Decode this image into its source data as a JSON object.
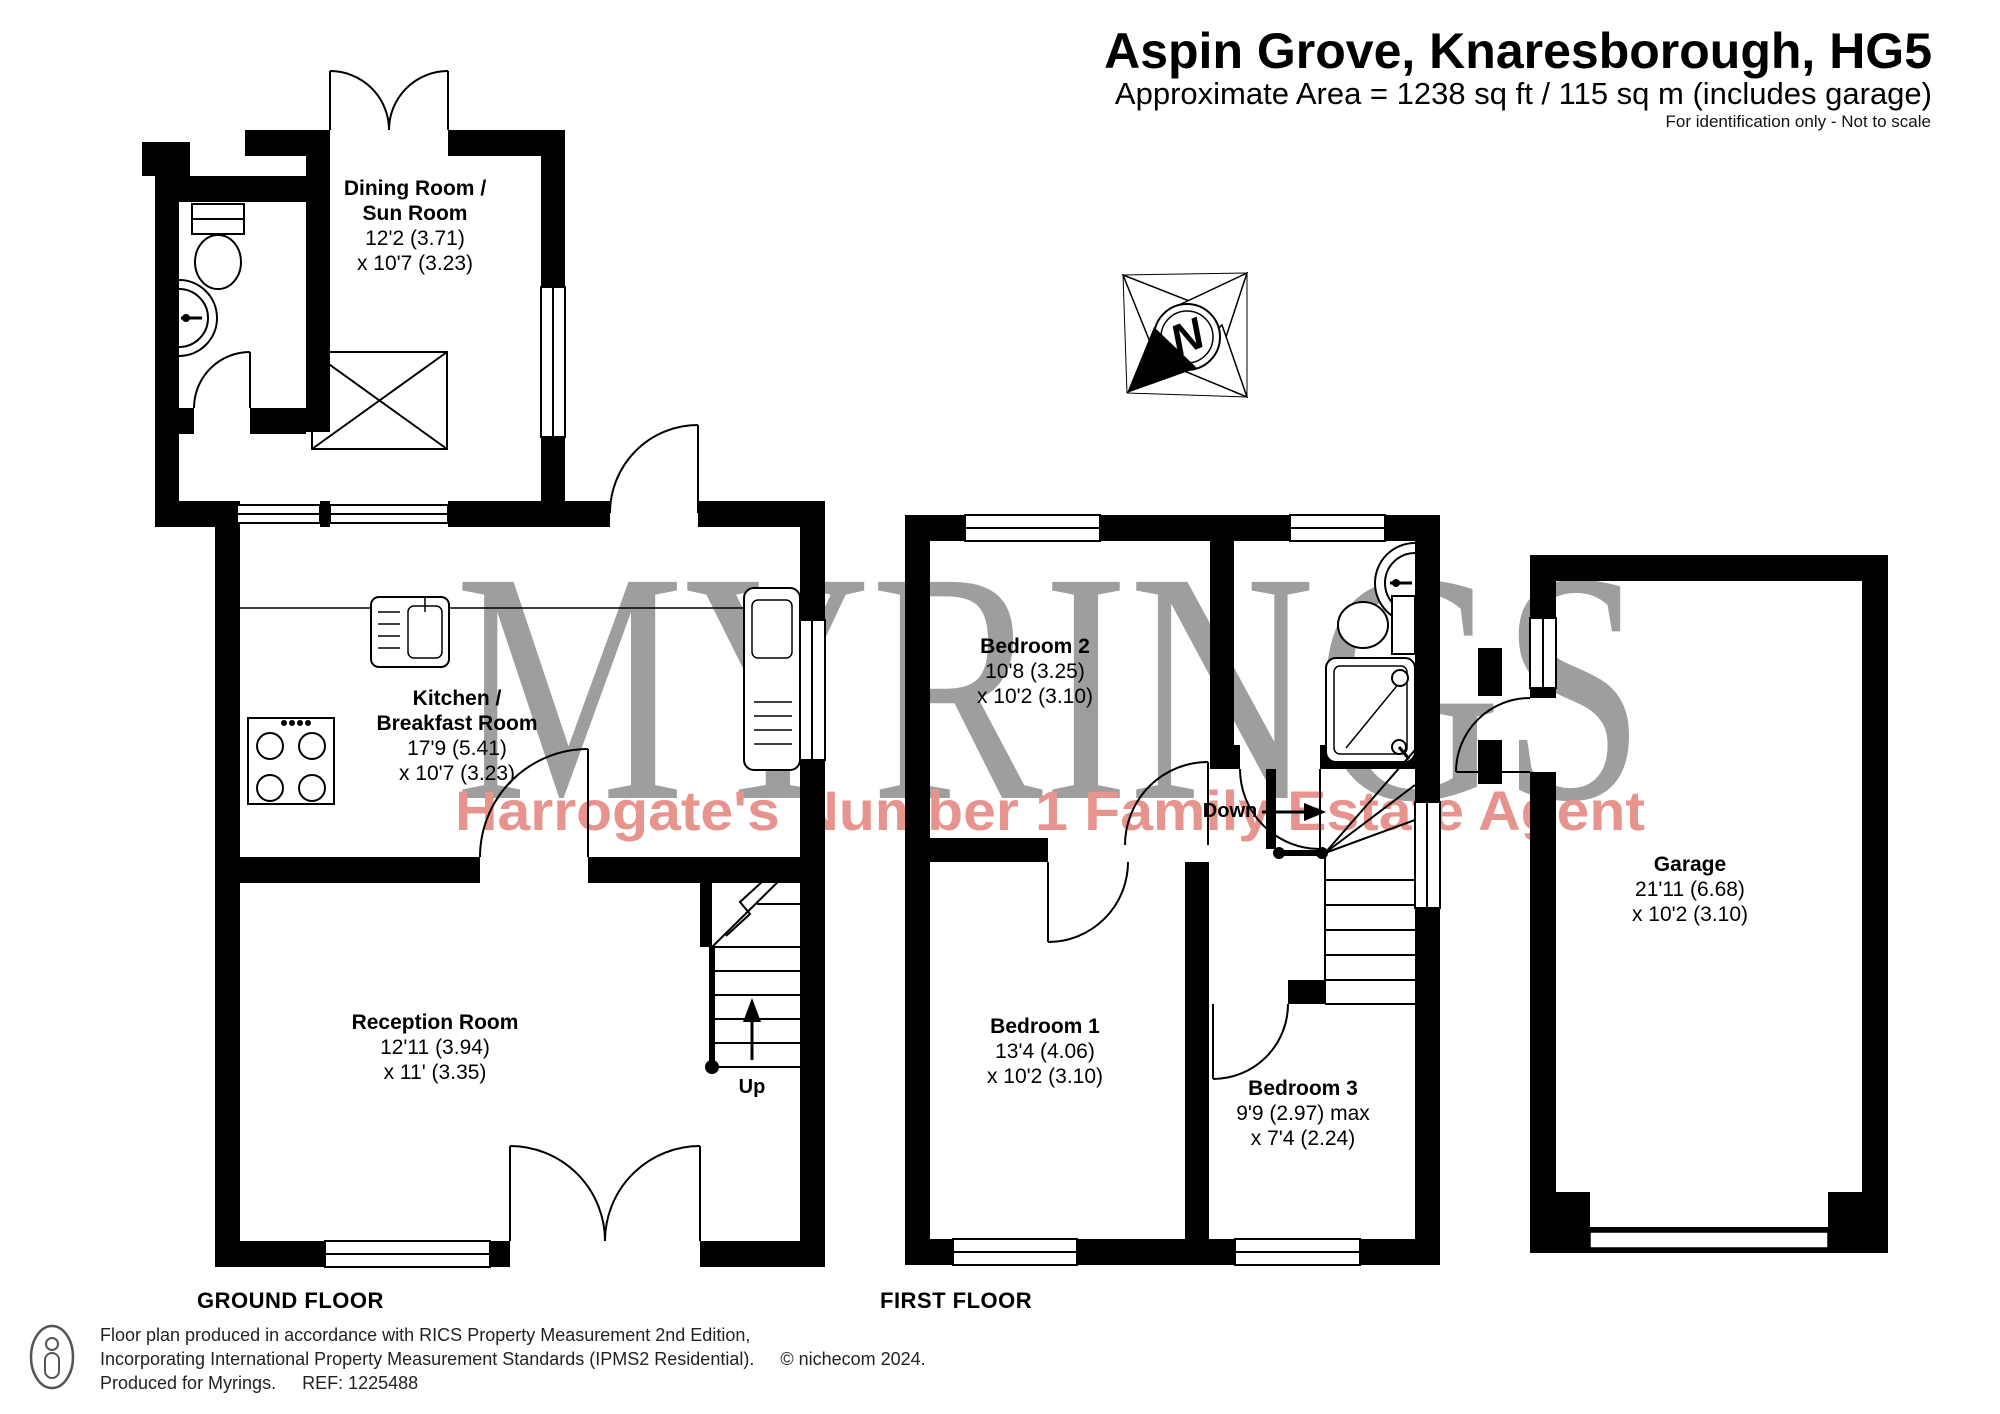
{
  "header": {
    "title": "Aspin Grove, Knaresborough, HG5",
    "subtitle": "Approximate Area = 1238 sq ft / 115 sq m (includes garage)",
    "note": "For identification only - Not to scale"
  },
  "watermark": {
    "brand": "MYRINGS",
    "tagline": "Harrogate's Number 1 Family Estate Agent",
    "brand_color": "#9e9e9e",
    "tagline_color": "#e8948e"
  },
  "colors": {
    "walls": "#000000",
    "lines": "#000000"
  },
  "compass": {
    "north_label": "N"
  },
  "floor_labels": {
    "ground": "GROUND FLOOR",
    "first": "FIRST FLOOR"
  },
  "rooms": {
    "dining": {
      "name1": "Dining Room /",
      "name2": "Sun Room",
      "dim1": "12'2 (3.71)",
      "dim2": "x 10'7 (3.23)"
    },
    "kitchen": {
      "name1": "Kitchen /",
      "name2": "Breakfast Room",
      "dim1": "17'9 (5.41)",
      "dim2": "x 10'7 (3.23)"
    },
    "reception": {
      "name1": "Reception Room",
      "dim1": "12'11 (3.94)",
      "dim2": "x 11' (3.35)"
    },
    "bedroom2": {
      "name1": "Bedroom 2",
      "dim1": "10'8 (3.25)",
      "dim2": "x 10'2 (3.10)"
    },
    "bedroom1": {
      "name1": "Bedroom 1",
      "dim1": "13'4 (4.06)",
      "dim2": "x 10'2 (3.10)"
    },
    "bedroom3": {
      "name1": "Bedroom 3",
      "dim1": "9'9 (2.97) max",
      "dim2": "x 7'4 (2.24)"
    },
    "garage": {
      "name1": "Garage",
      "dim1": "21'11 (6.68)",
      "dim2": "x 10'2 (3.10)"
    }
  },
  "stairs": {
    "up": "Up",
    "down": "Down"
  },
  "footer": {
    "line1": "Floor plan produced in accordance with RICS Property Measurement 2nd Edition,",
    "line2a": "Incorporating International Property Measurement Standards (IPMS2 Residential).",
    "line2b": "© nichecom 2024.",
    "line3a": "Produced for Myrings.",
    "line3b": "REF: 1225488"
  }
}
